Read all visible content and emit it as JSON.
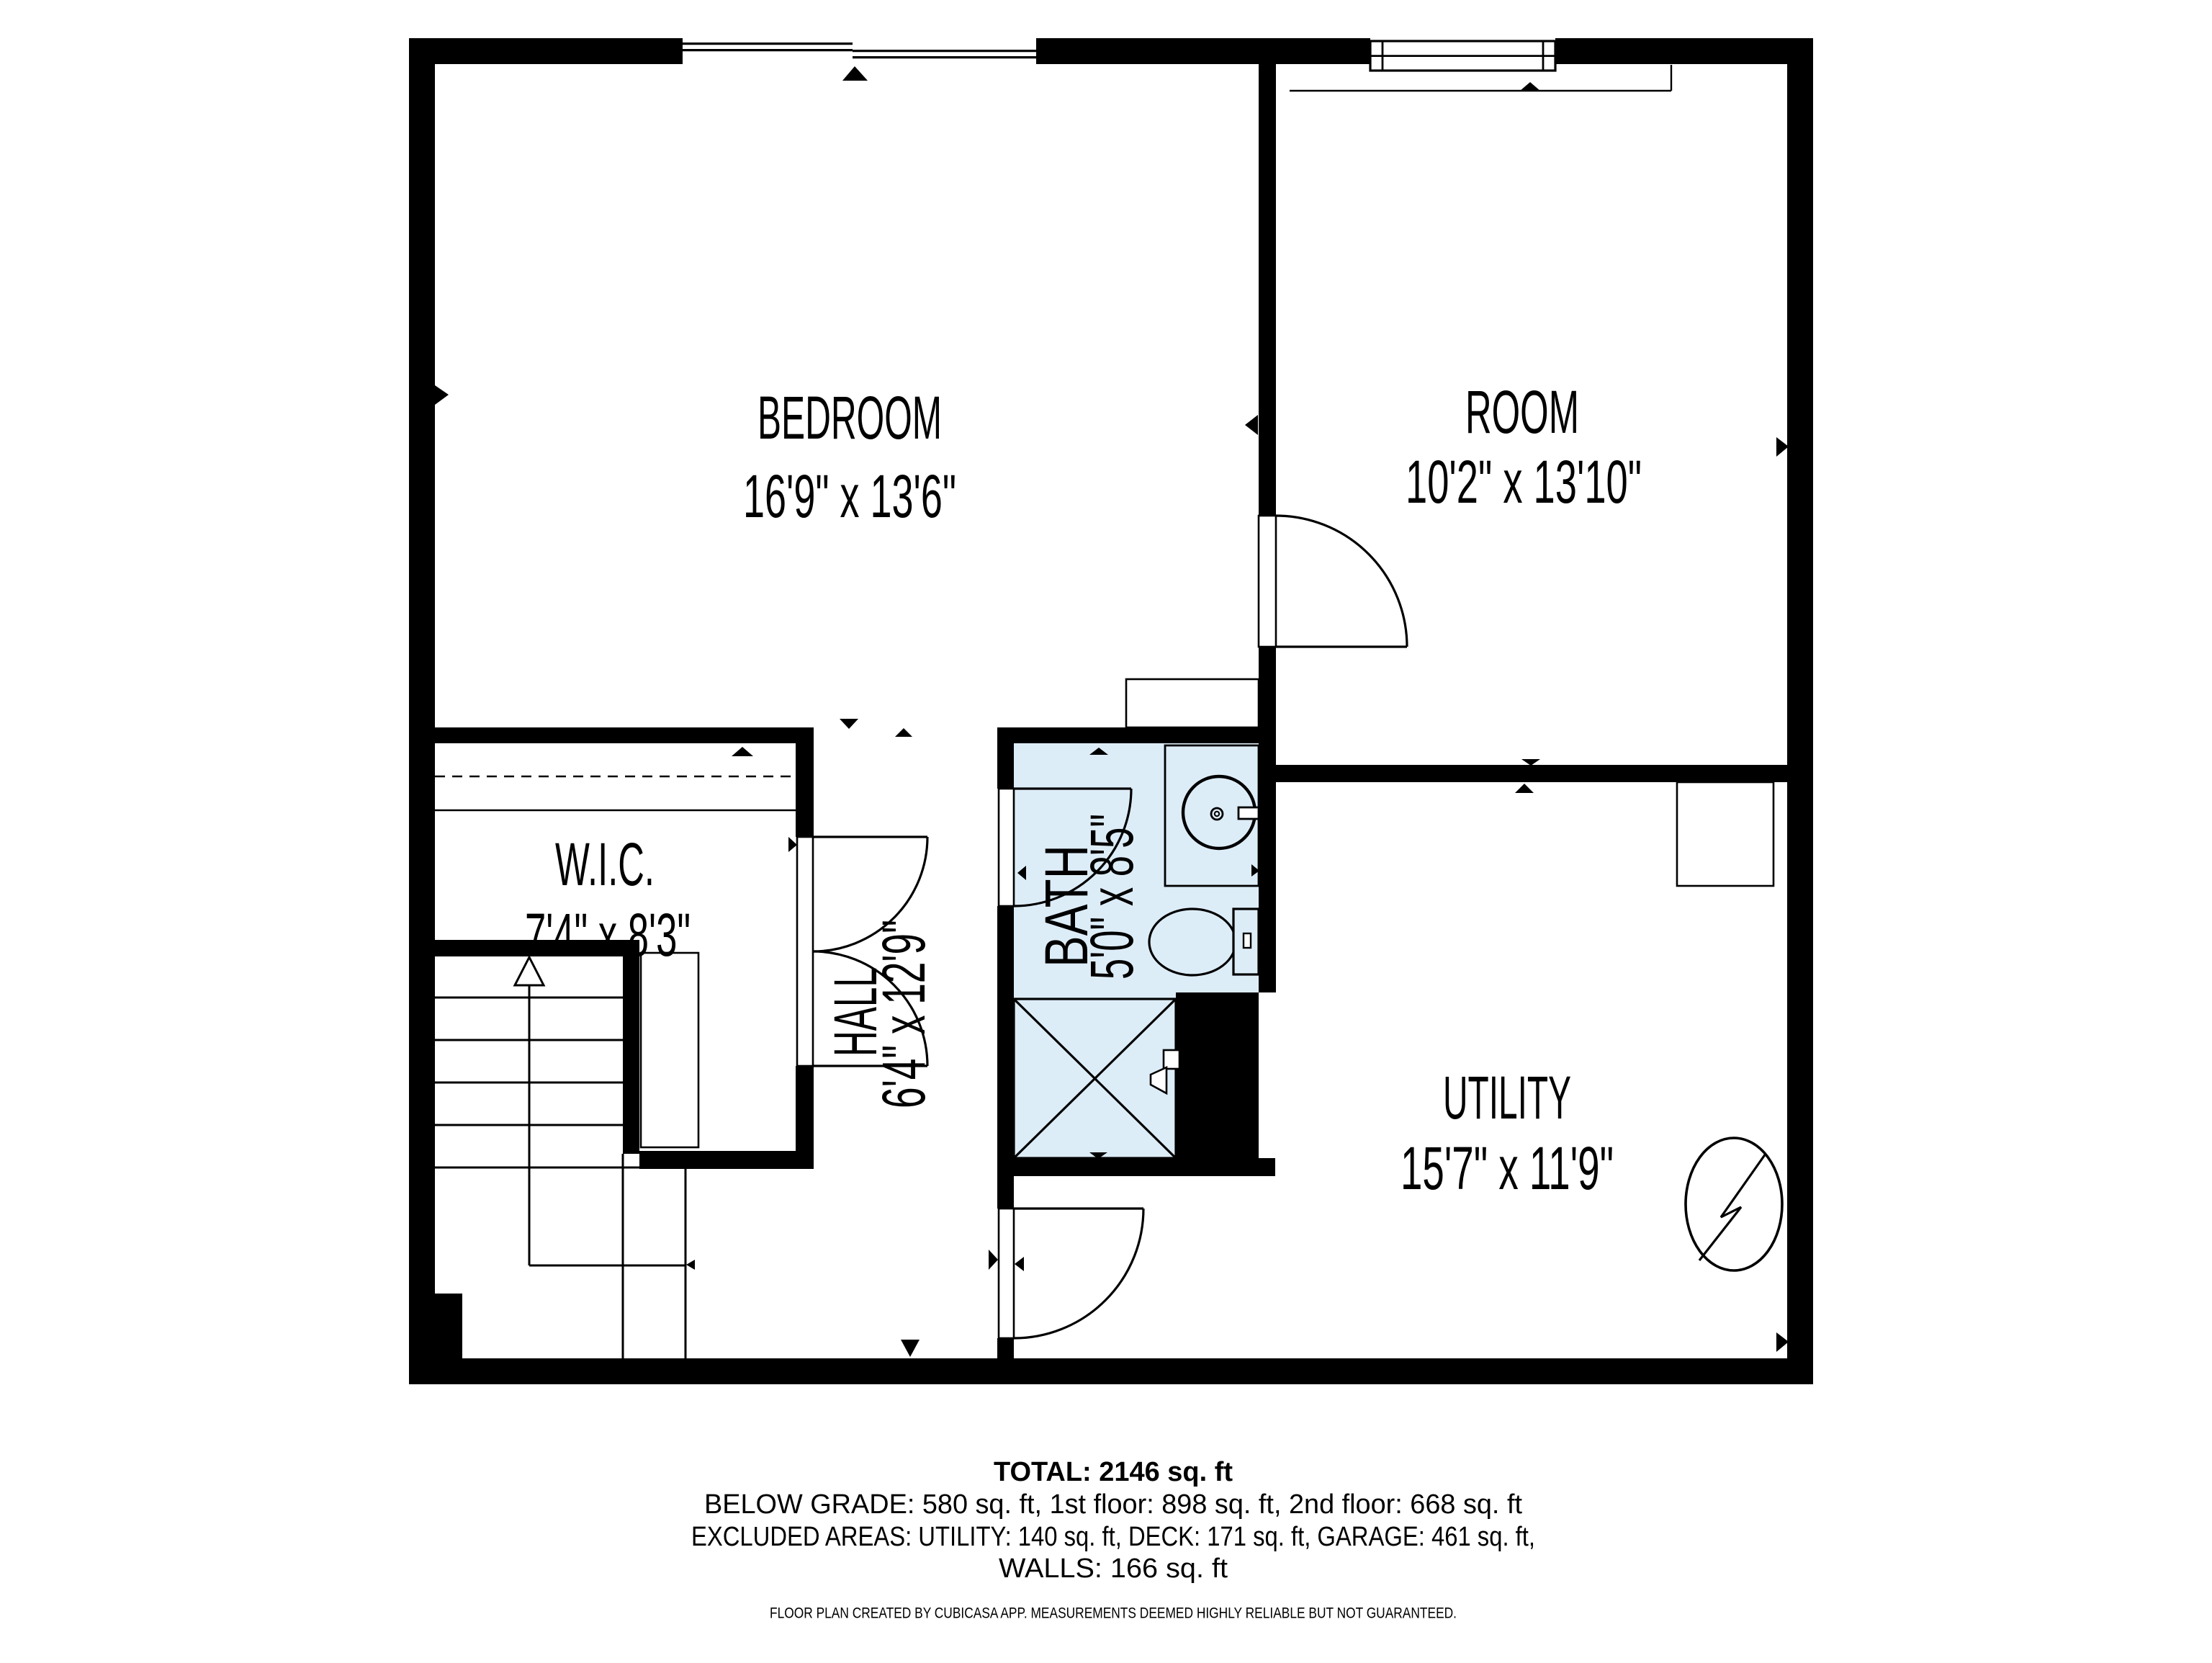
{
  "plan": {
    "rooms": [
      {
        "name": "BEDROOM",
        "dims": "16'9\" x 13'6\""
      },
      {
        "name": "ROOM",
        "dims": "10'2\" x 13'10\""
      },
      {
        "name": "W.I.C.",
        "dims": "7'4\" x 8'3\""
      },
      {
        "name": "HALL",
        "dims": "6'4\" x 12'9\""
      },
      {
        "name": "BATH",
        "dims": "5'0\" x 8'5\""
      },
      {
        "name": "UTILITY",
        "dims": "15'7\" x 11'9\""
      }
    ],
    "colors": {
      "wall": "#000000",
      "bath_floor": "#ddedf8",
      "background": "#ffffff",
      "line": "#000000"
    },
    "icons": [
      "stairs-up-arrow-icon",
      "double-door-icon",
      "door-swing-icon",
      "window-icon",
      "sink-icon",
      "toilet-icon",
      "shower-icon",
      "electrical-panel-icon",
      "closet-rod-dashed-icon"
    ]
  },
  "summary": {
    "total": "TOTAL: 2146 sq. ft",
    "line2": "BELOW GRADE: 580 sq. ft, 1st floor: 898 sq. ft, 2nd floor: 668 sq. ft",
    "line3": "EXCLUDED AREAS: UTILITY: 140 sq. ft, DECK: 171 sq. ft, GARAGE: 461 sq. ft,",
    "line4": "WALLS: 166 sq. ft",
    "disclaimer": "FLOOR PLAN CREATED BY CUBICASA APP. MEASUREMENTS DEEMED HIGHLY RELIABLE BUT NOT GUARANTEED."
  }
}
